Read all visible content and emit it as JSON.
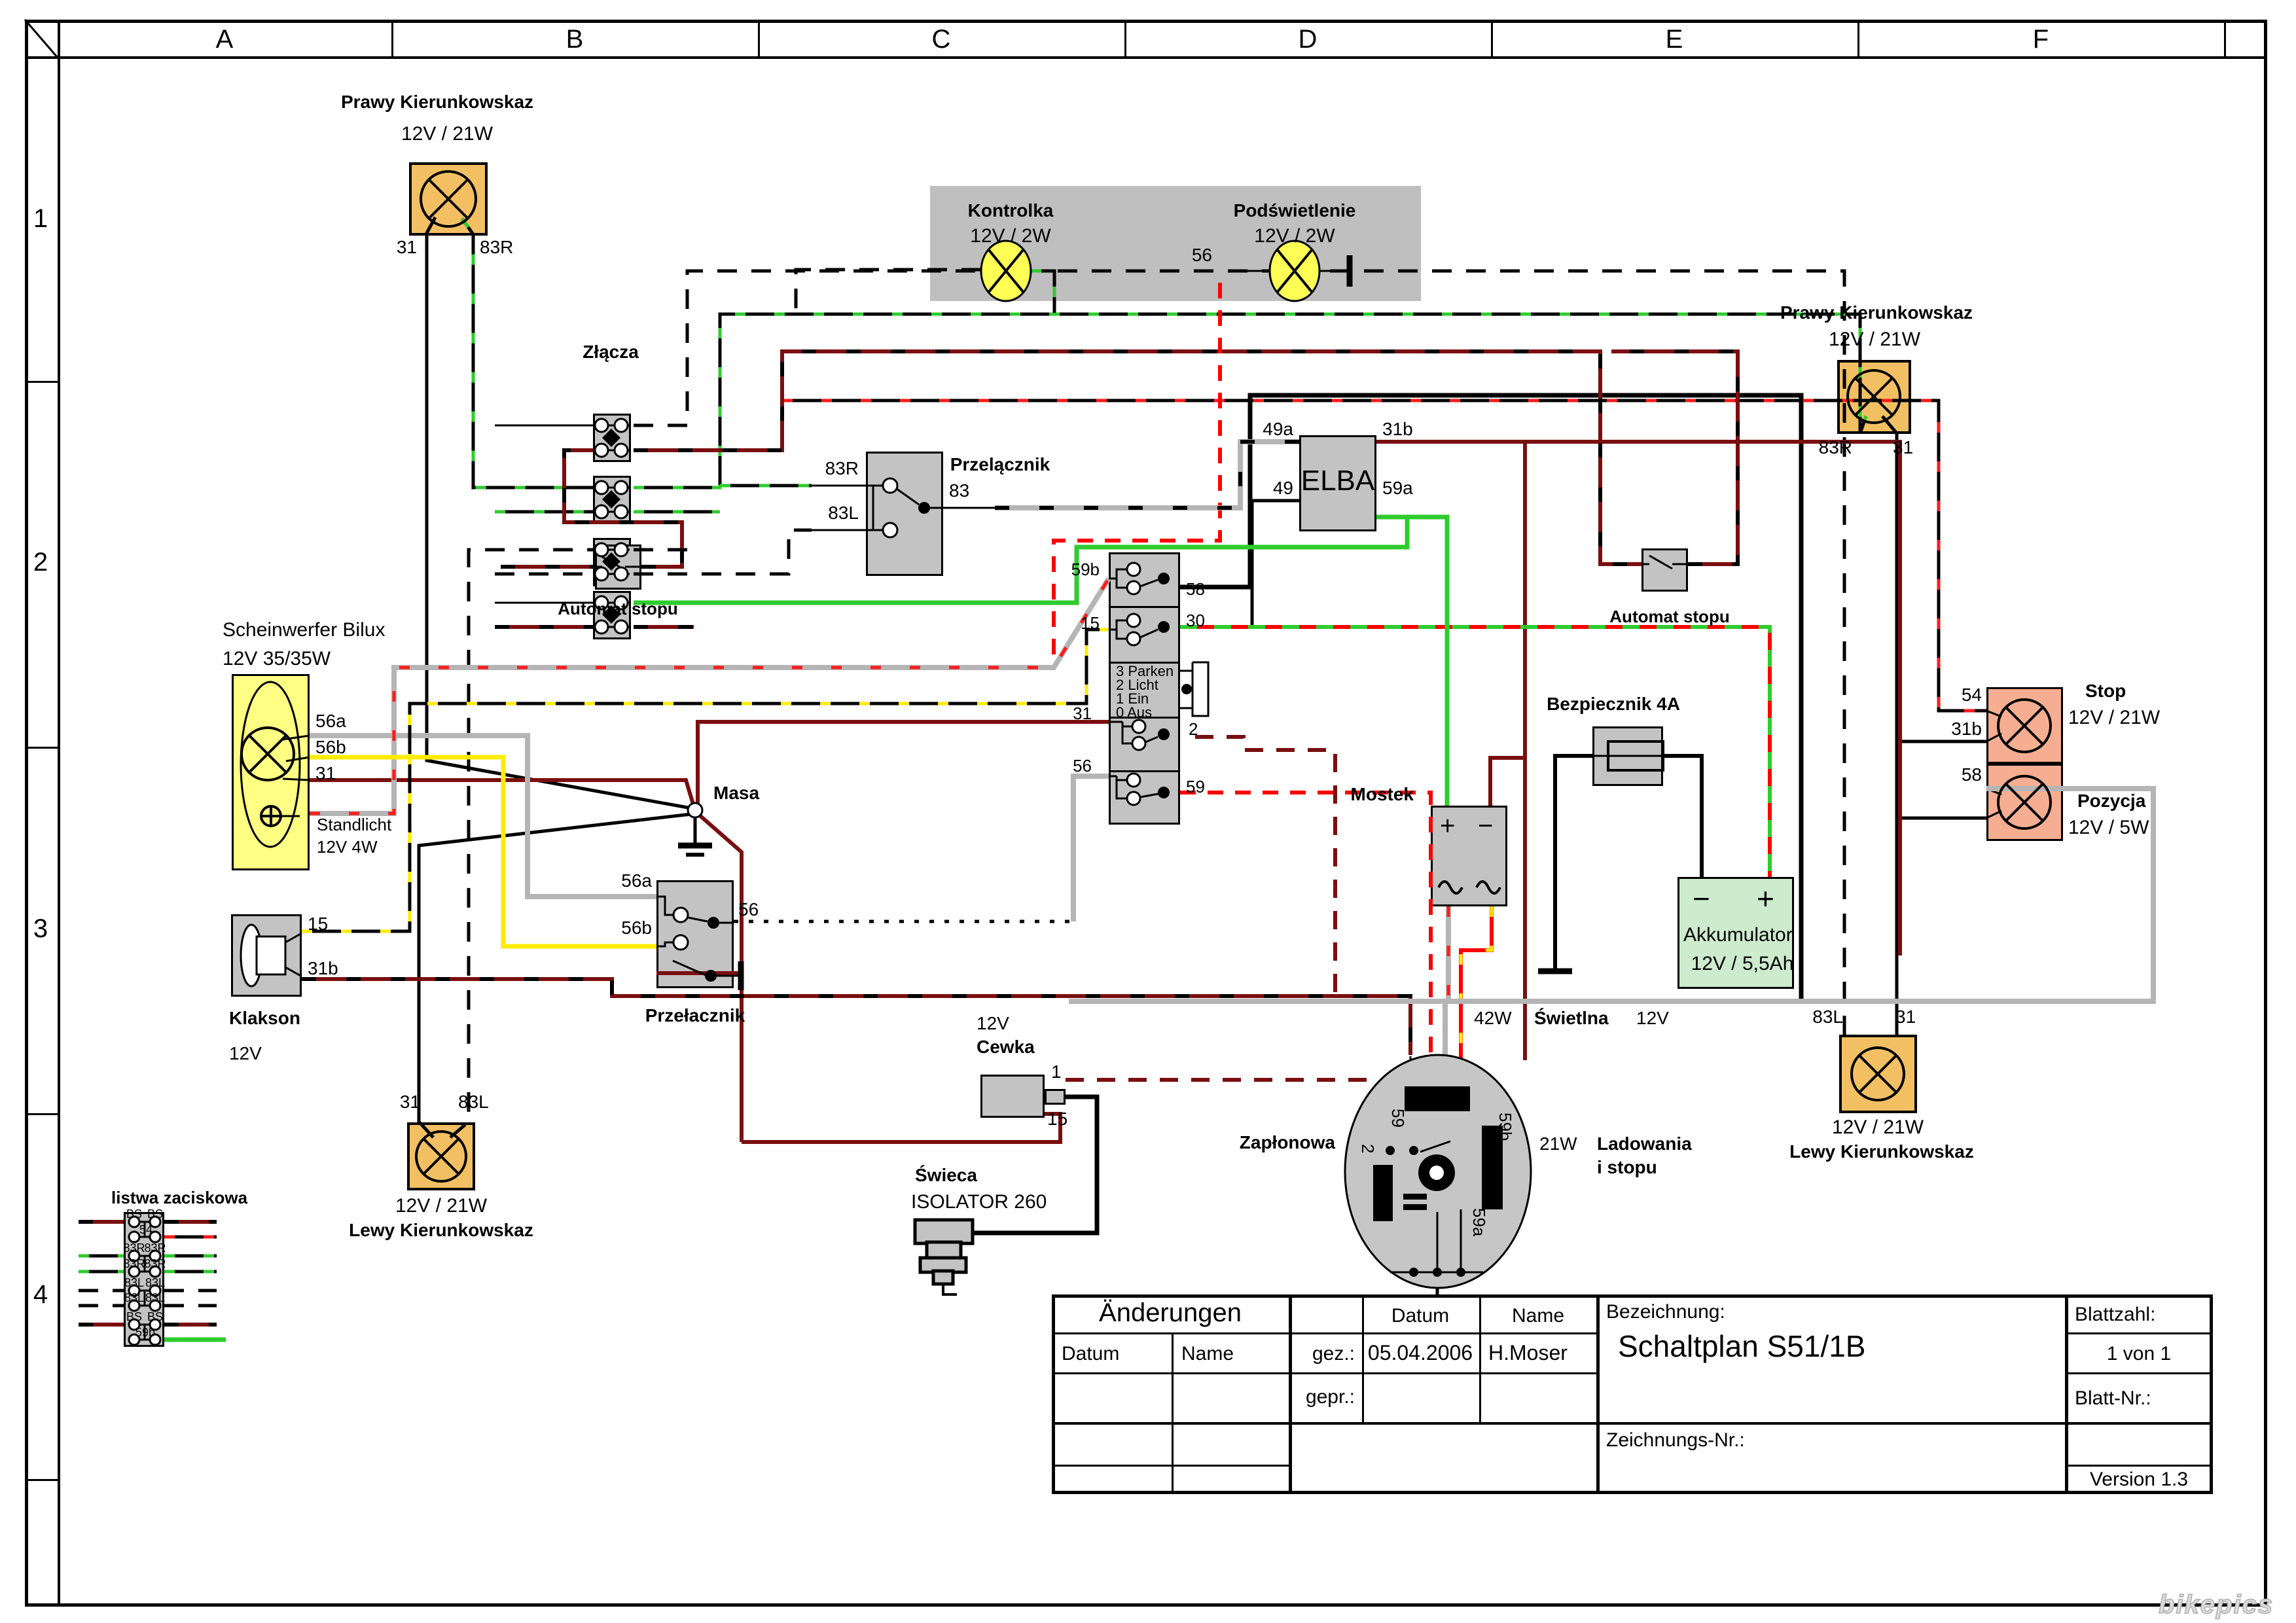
{
  "frame": {
    "cols": [
      "A",
      "B",
      "C",
      "D",
      "E",
      "F"
    ],
    "rows": [
      "1",
      "2",
      "3",
      "4"
    ]
  },
  "c": {
    "ftr": {
      "name": "Prawy Kierunkowskaz",
      "rating": "12V / 21W",
      "t31": "31",
      "t83r": "83R"
    },
    "panel": {
      "k_name": "Kontrolka",
      "k_rating": "12V / 2W",
      "p_name": "Podświetlenie",
      "p_rating": "12V / 2W",
      "t56": "56"
    },
    "zl": {
      "name": "Złącza"
    },
    "sw1": {
      "name": "Przelącznik",
      "t83r": "83R",
      "t83l": "83L",
      "t83": "83"
    },
    "elba": {
      "name": "ELBA",
      "t49a": "49a",
      "t49": "49",
      "t31b": "31b",
      "t59a": "59a"
    },
    "asl": {
      "name": "Automat stopu"
    },
    "asr": {
      "name": "Automat stopu"
    },
    "head": {
      "name": "Scheinwerfer Bilux",
      "rating": "12V 35/35W",
      "t56a": "56a",
      "t56b": "56b",
      "t31": "31",
      "st1": "Standlicht",
      "st2": "12V 4W"
    },
    "horn": {
      "name": "Klakson",
      "rating": "12V",
      "t15": "15",
      "t31b": "31b"
    },
    "sw2": {
      "name": "Przełacznik",
      "t56a": "56a",
      "t56b": "56b",
      "t56": "56"
    },
    "masa": {
      "name": "Masa"
    },
    "ign": {
      "p3": "3 Parken",
      "p2": "2 Licht",
      "p1": "1 Ein",
      "p0": "0 Aus",
      "t59b": "59b",
      "t15": "15",
      "t31": "31",
      "t56": "56",
      "t58": "58",
      "t30": "30",
      "t2": "2",
      "t59": "59"
    },
    "most": {
      "name": "Mostek",
      "plus": "+",
      "minus": "−"
    },
    "fuse": {
      "name": "Bezpiecznik 4A"
    },
    "akku": {
      "name": "Akkumulator",
      "rating": "12V / 5,5Ah",
      "plus": "+",
      "minus": "−"
    },
    "cewka": {
      "v": "12V",
      "name": "Cewka",
      "t1": "1",
      "t15": "15"
    },
    "swieca": {
      "name": "Świeca",
      "type": "ISOLATOR 260"
    },
    "mag": {
      "name": "Zapłonowa",
      "top1": "42W",
      "top2": "Świetlna",
      "top3": "12V",
      "r1a": "21W",
      "r1b": "Ladowania",
      "r2": "i stopu",
      "t59": "59",
      "t2": "2",
      "t59b": "59b",
      "t59a": "59a"
    },
    "stop": {
      "name": "Stop",
      "rating": "12V / 21W",
      "t54": "54",
      "t31b": "31b"
    },
    "poz": {
      "name": "Pozycja",
      "rating": "12V / 5W",
      "t58": "58"
    },
    "rtr": {
      "name": "Prawy Kierunkowskaz",
      "rating": "12V / 21W",
      "t83r": "83R",
      "t31": "31"
    },
    "rbl": {
      "name": "Lewy Kierunkowskaz",
      "rating": "12V / 21W",
      "t83l": "83L",
      "t31": "31"
    },
    "fbl": {
      "name": "Lewy Kierunkowskaz",
      "rating": "12V / 21W",
      "t31": "31",
      "t83l": "83L"
    },
    "listwa": {
      "name": "listwa zaciskowa",
      "rows": [
        [
          "BS",
          "BS"
        ],
        [
          "",
          "54"
        ],
        [
          "83R",
          "83R"
        ],
        [
          "83R",
          "83R"
        ],
        [
          "83L",
          "83L"
        ],
        [
          "83L",
          "83L"
        ],
        [
          "BS",
          "BS"
        ],
        [
          "",
          "59b"
        ]
      ]
    }
  },
  "tb": {
    "and": "Änderungen",
    "datum": "Datum",
    "name": "Name",
    "gez": "gez.:",
    "gepr": "gepr.:",
    "gez_d": "05.04.2006",
    "gez_n": "H.Moser",
    "bez": "Bezeichnung:",
    "title": "Schaltplan S51/1B",
    "znr": "Zeichnungs-Nr.:",
    "bz": "Blattzahl:",
    "bz_v": "1 von 1",
    "bnr": "Blatt-Nr.:",
    "ver": "Version 1.3"
  },
  "wm": "bikepics",
  "colors": {
    "orange": "#f2c063",
    "lamp_yellow": "#ffff55",
    "headlight_yellow": "#ffff84",
    "salmon": "#f5ae91",
    "battery_green": "#cdebcd",
    "component_gray": "#c3c3c3",
    "wire_green": "#2ecc2e",
    "wire_dark_red": "#7a0f10",
    "wire_red": "#ff0000",
    "wire_gray": "#b5b5b5",
    "wire_yellow": "#ffec00"
  }
}
